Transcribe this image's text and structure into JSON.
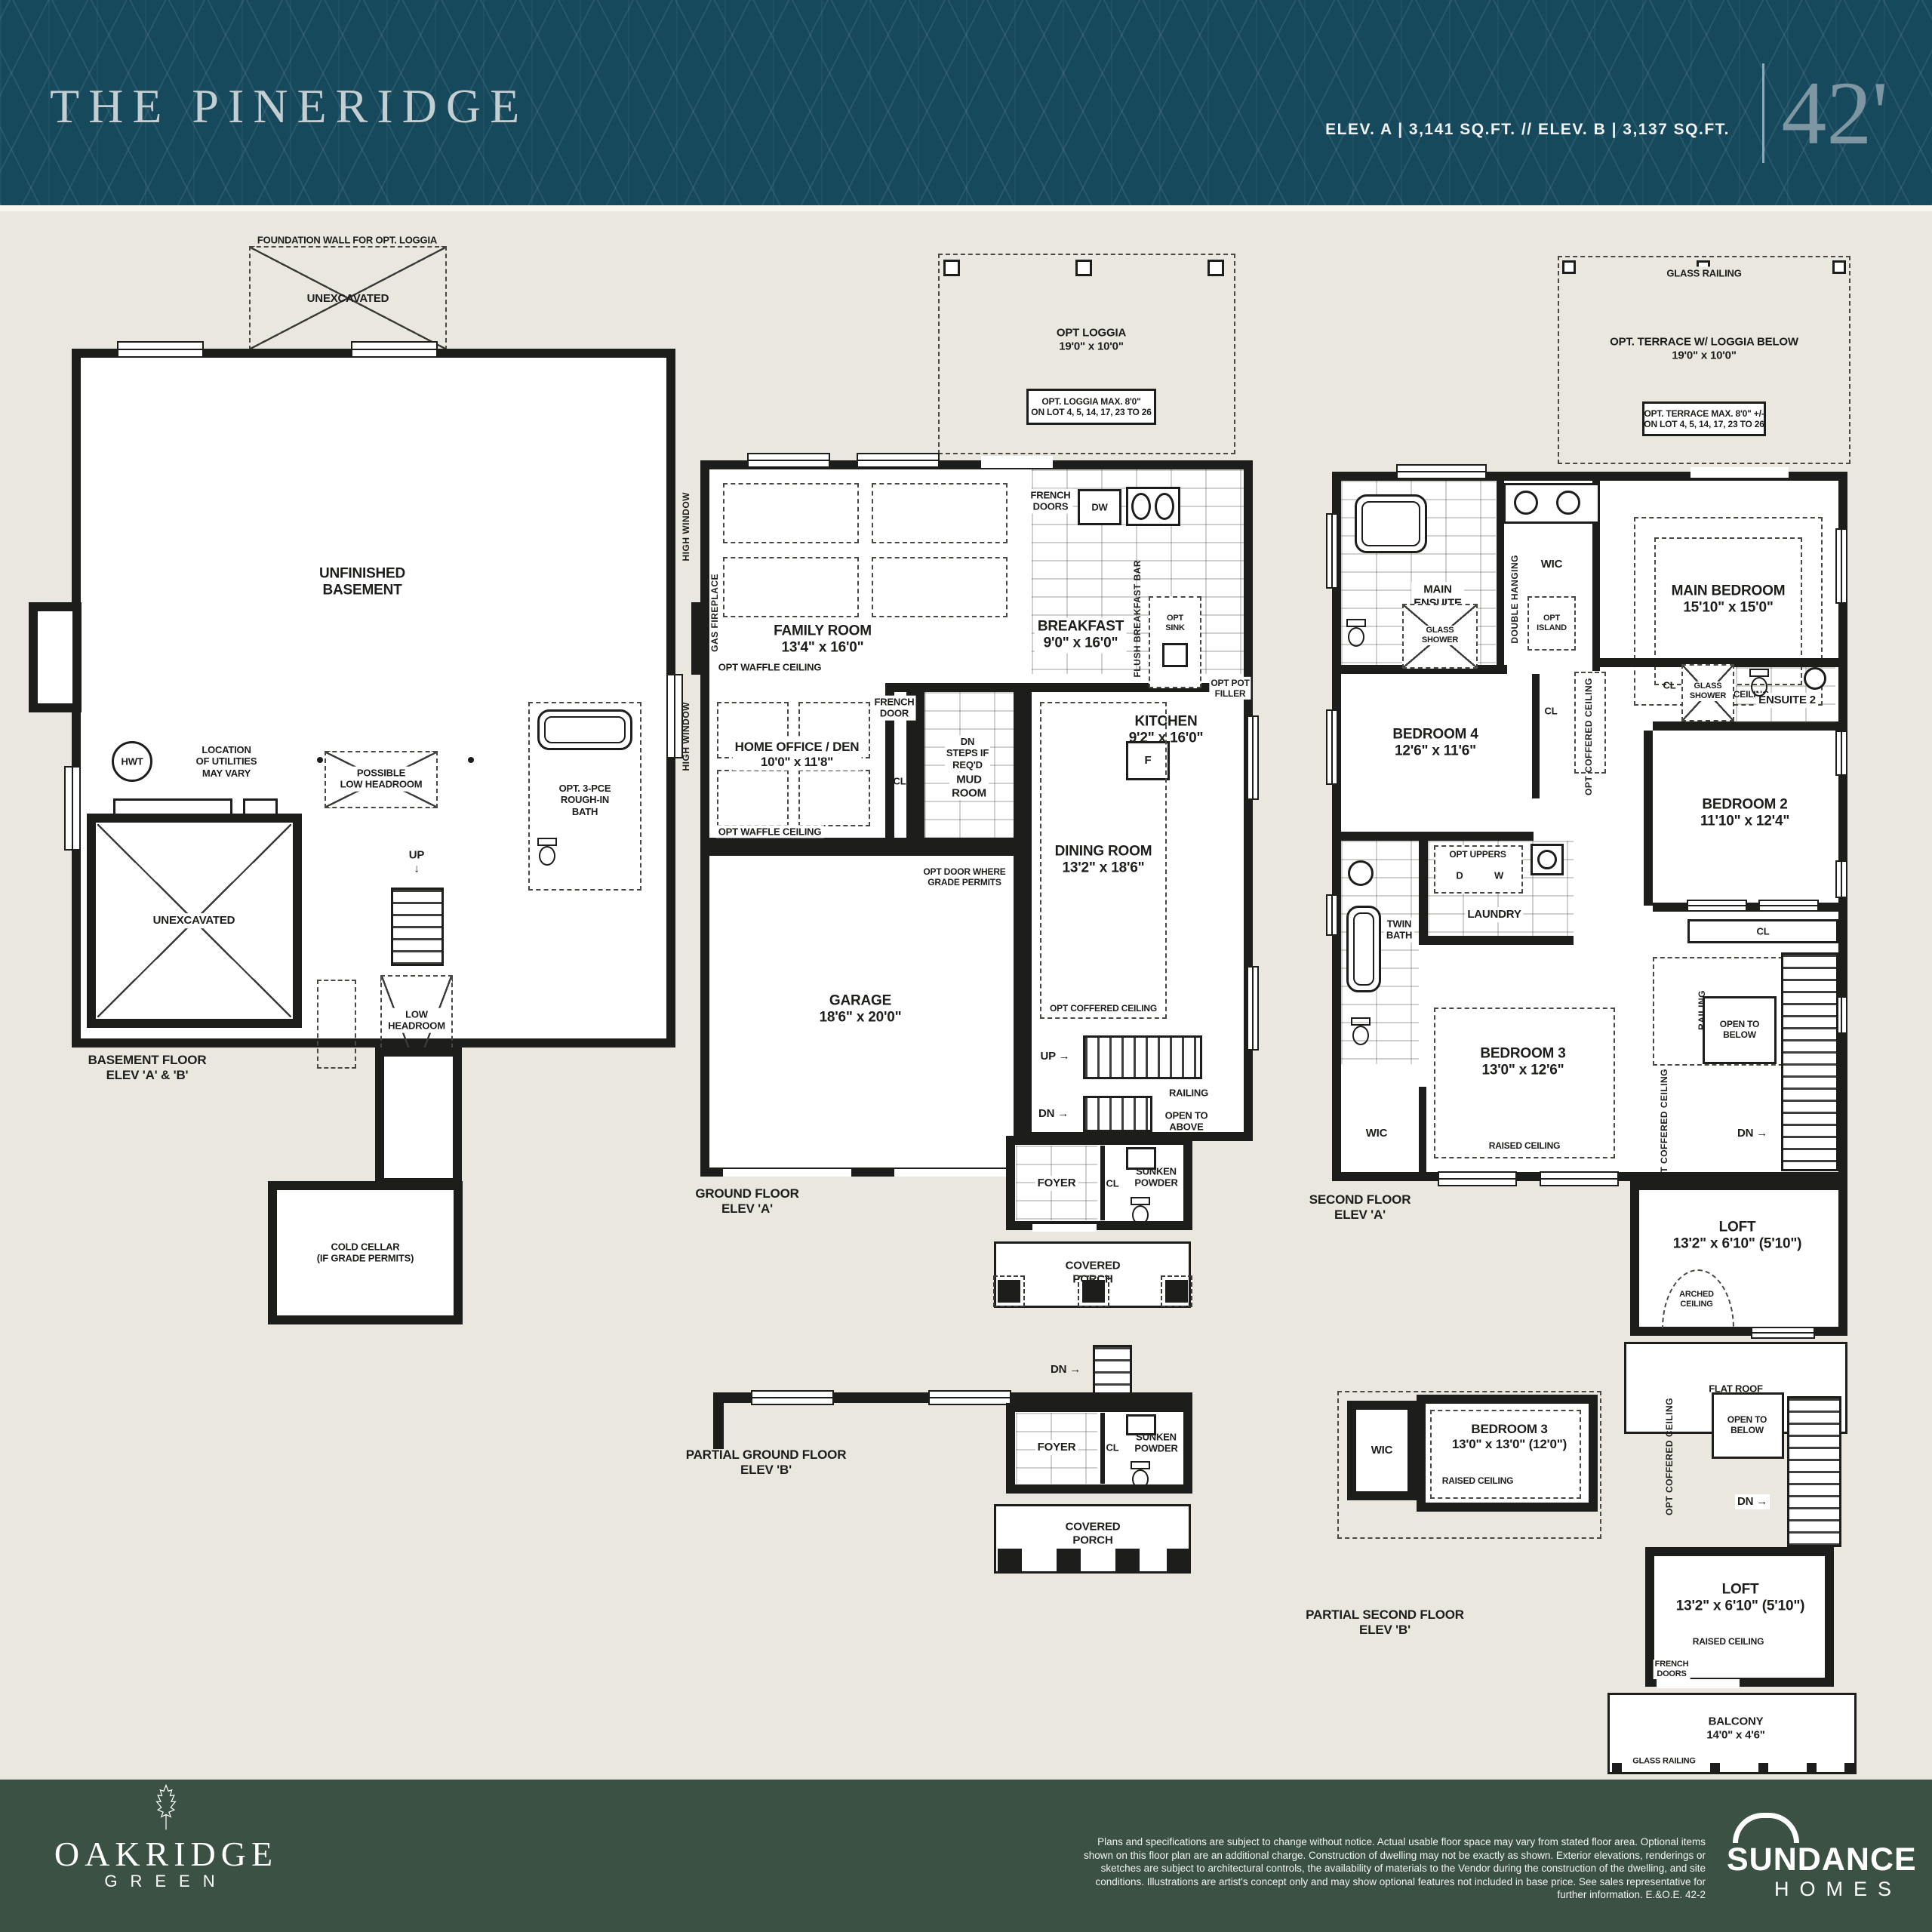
{
  "header": {
    "title": "THE PINERIDGE",
    "specs": "ELEV. A  |  3,141 SQ.FT.  //  ELEV. B  |  3,137 SQ.FT.",
    "lot_width": "42'"
  },
  "colors": {
    "header_bg": "#17495c",
    "header_title": "#c3ced2",
    "lot_width_text": "#7e95a2",
    "page_bg": "#eae7df",
    "plan_line": "#1d1d1b",
    "footer_bg": "#3a5143"
  },
  "plans": {
    "basement": {
      "labels": {
        "foundation": "FOUNDATION WALL FOR OPT. LOGGIA",
        "unexcavated_top": "UNEXCAVATED",
        "unfinished": "UNFINISHED\nBASEMENT",
        "hwt": "HWT",
        "utilities": "LOCATION\nOF UTILITIES\nMAY VARY",
        "furnace": "F w/HRV",
        "possible_low_headroom": "POSSIBLE\nLOW HEADROOM",
        "opt_bath": "OPT. 3-PCE\nROUGH-IN\nBATH",
        "unexcavated_main": "UNEXCAVATED",
        "up": "UP\n↓",
        "low_headroom": "LOW\nHEADROOM",
        "cold_cellar": "COLD CELLAR\n(IF GRADE PERMITS)",
        "title": "BASEMENT FLOOR\nELEV 'A' & 'B'"
      }
    },
    "ground": {
      "labels": {
        "opt_loggia": "OPT LOGGIA\n19'0\" x 10'0\"",
        "loggia_note": "OPT. LOGGIA MAX. 8'0\"\nON LOT 4, 5, 14, 17, 23 TO 26",
        "french_doors": "FRENCH\nDOORS",
        "dw": "DW",
        "family_room": "FAMILY ROOM\n13'4\" x 16'0\"",
        "breakfast": "BREAKFAST\n9'0\" x 16'0\"",
        "flush_bar": "FLUSH BREAKFAST BAR",
        "opt_sink": "OPT\nSINK",
        "opt_pot_filler": "OPT POT\nFILLER",
        "kitchen": "KITCHEN\n9'2\" x 16'0\"",
        "fridge": "F",
        "waffle": "OPT WAFFLE CEILING",
        "gas_fireplace": "GAS FIREPLACE",
        "high_window": "HIGH WINDOW",
        "french_door": "FRENCH\nDOOR",
        "dn_steps": "DN\nSTEPS IF\nREQ'D",
        "home_office": "HOME OFFICE / DEN\n10'0\" x 11'8\"",
        "cl": "CL",
        "mud_room": "MUD\nROOM",
        "opt_door": "OPT DOOR WHERE\nGRADE PERMITS",
        "dining": "DINING ROOM\n13'2\" x 18'6\"",
        "coffered": "OPT COFFERED CEILING",
        "garage": "GARAGE\n18'6\" x 20'0\"",
        "up": "UP →",
        "dn": "DN →",
        "railing": "RAILING",
        "open_above": "OPEN TO\nABOVE",
        "foyer": "FOYER",
        "sunken_powder": "SUNKEN\nPOWDER",
        "covered_porch": "COVERED\nPORCH",
        "title": "GROUND FLOOR\nELEV 'A'"
      }
    },
    "ground_b": {
      "labels": {
        "dn": "DN →",
        "foyer": "FOYER",
        "cl": "CL",
        "sunken_powder": "SUNKEN\nPOWDER",
        "covered_porch": "COVERED\nPORCH",
        "title": "PARTIAL GROUND FLOOR\nELEV 'B'"
      }
    },
    "second": {
      "labels": {
        "glass_railing": "GLASS RAILING",
        "opt_terrace": "OPT. TERRACE W/ LOGGIA BELOW\n19'0\" x 10'0\"",
        "terrace_note": "OPT. TERRACE MAX. 8'0\" +/-\nON LOT 4, 5, 14, 17, 23 TO 26",
        "main_ensuite": "MAIN\nENSUITE",
        "glass_shower": "GLASS\nSHOWER",
        "wic": "WIC",
        "double_hanging": "DOUBLE HANGING",
        "opt_island": "OPT\nISLAND",
        "main_bedroom": "MAIN BEDROOM\n15'10\" x 15'0\"",
        "opt_tray": "OPT TRAY CEILING",
        "cl": "CL",
        "ensuite2": "ENSUITE 2",
        "bedroom4": "BEDROOM 4\n12'6\" x 11'6\"",
        "coffered": "OPT COFFERED CEILING",
        "bedroom2": "BEDROOM 2\n11'10\" x 12'4\"",
        "opt_uppers": "OPT UPPERS",
        "d": "D",
        "w": "W",
        "laundry": "LAUNDRY",
        "twin_bath": "TWIN\nBATH",
        "bedroom3": "BEDROOM 3\n13'0\" x 12'6\"",
        "raised_ceiling": "RAISED CEILING",
        "railing": "RAILING",
        "open_below": "OPEN TO\nBELOW",
        "dn": "DN →",
        "loft": "LOFT\n13'2\" x 6'10\" (5'10\")",
        "arched": "ARCHED\nCEILING",
        "flat_roof": "FLAT ROOF",
        "title": "SECOND FLOOR\nELEV 'A'"
      }
    },
    "second_b": {
      "labels": {
        "wic": "WIC",
        "raised_ceiling": "RAISED CEILING",
        "bedroom3": "BEDROOM 3\n13'0\" x 13'0\" (12'0\")",
        "coffered": "OPT COFFERED CEILING",
        "open_below": "OPEN TO\nBELOW",
        "dn": "DN →",
        "loft": "LOFT\n13'2\" x 6'10\" (5'10\")",
        "raised_ceiling2": "RAISED CEILING",
        "french_doors": "FRENCH\nDOORS",
        "balcony": "BALCONY\n14'0\" x 4'6\"",
        "glass_railing": "GLASS RAILING",
        "title": "PARTIAL SECOND FLOOR\nELEV 'B'"
      }
    }
  },
  "footer": {
    "community_name": "OAKRIDGE",
    "community_sub": "GREEN",
    "disclaimer": "Plans and specifications are subject to change without notice. Actual usable floor space may vary from stated floor area. Optional items shown on this floor plan are an additional charge. Construction of dwelling may not be exactly as shown. Exterior elevations, renderings or sketches are subject to architectural controls, the availability of materials to the Vendor during the construction of the dwelling, and site conditions. Illustrations are artist's concept only and may show optional features not included in base price. See sales representative for further information. E.&O.E.  42-2",
    "builder_name": "SUNDANCE",
    "builder_sub": "HOMES"
  }
}
